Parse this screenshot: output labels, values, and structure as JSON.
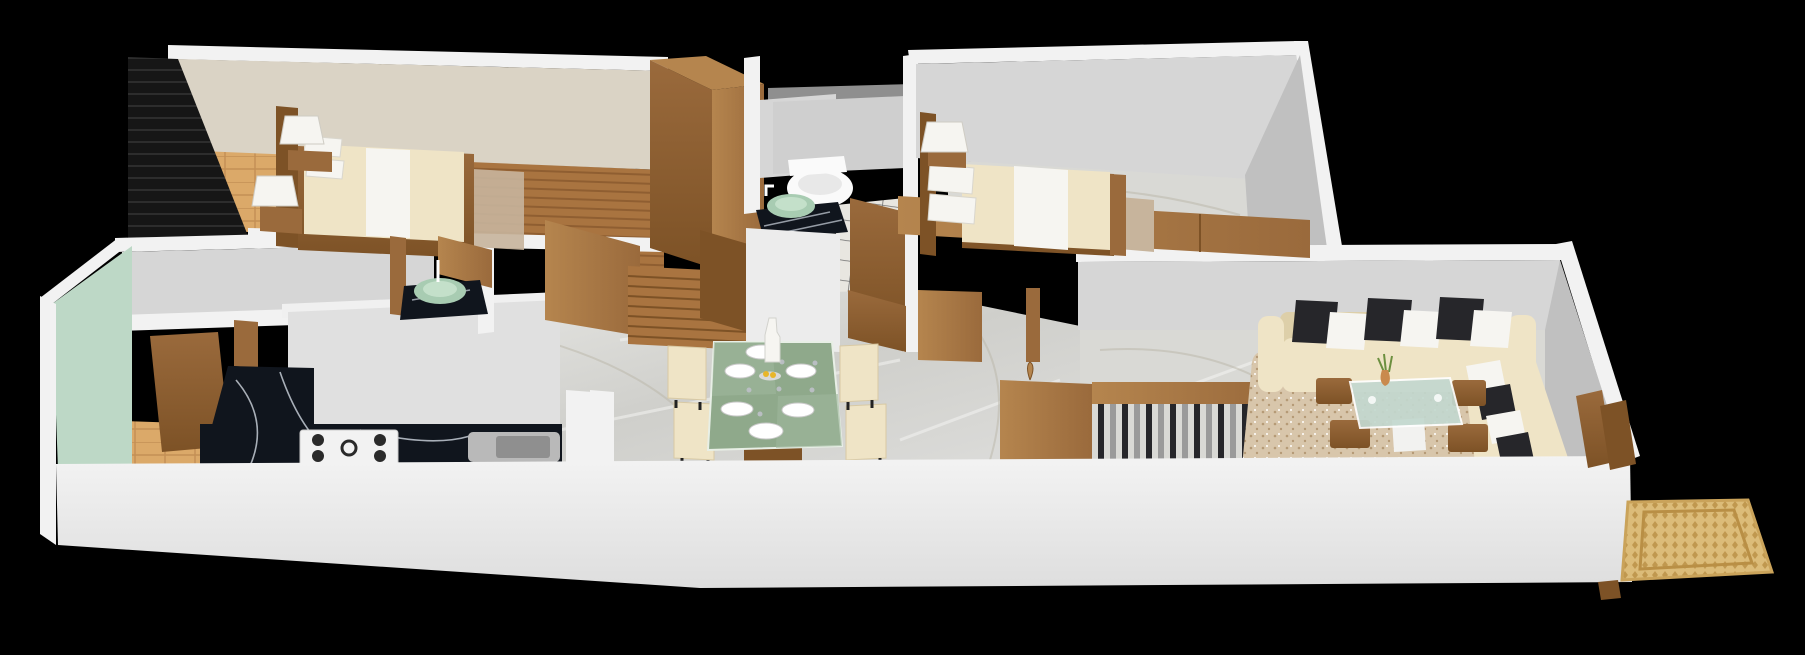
{
  "scene": {
    "kind": "3d-floor-plan-render",
    "description": "Isometric 3D render of an apartment floor plan on a black background",
    "canvas": {
      "width": 1805,
      "height": 655
    }
  },
  "palette": {
    "background": "#000000",
    "wallOuter": "#f2f2f2",
    "wallFace": "#d6d6d6",
    "wallFaceDark": "#c0c0c0",
    "wallBeige": "#dad3c5",
    "mintWall": "#bdd8c6",
    "woodMid": "#9a6a3c",
    "woodDark": "#7d5226",
    "woodLight": "#b5854e",
    "woodFloorA": "#a97440",
    "woodFloorB": "#8f5e31",
    "blackWardrobe": "#161616",
    "tanTile": "#dba969",
    "tanGrout": "#c38f55",
    "marbleFloor": "#d9d9d5",
    "marbleVein": "#b9b5a7",
    "blackMarble": "#10151d",
    "blackMarbleVein": "#cfd6df",
    "cream": "#efe4c6",
    "creamShadow": "#ddcfa9",
    "linenWhite": "#f6f5f1",
    "pillowBlack": "#26262a",
    "glassGreen": "#a8ccb2",
    "diningGlass": "#8fa98b",
    "coffeeGlass": "#c3d8cf",
    "rugBeige": "#d8c6ab",
    "rugSpeckle": "#b59a76",
    "rugBedroom": "#c7b49c",
    "doormatBase": "#dcbc79",
    "doormatPattern": "#b98f45",
    "steelGray": "#9a9a9a",
    "toiletWhite": "#fafafa",
    "plantGreen": "#6c8f3f",
    "fruitYellow": "#e8b62a",
    "tileGrout": "#6f6f6f",
    "bathTile": "#e8e6e0",
    "fascia": "#ececec"
  },
  "rooms": [
    {
      "id": "bedroom-1",
      "position": "top-left",
      "items": [
        "black-slatted-wardrobe",
        "double-bed",
        "wood-headboard",
        "cream-duvet",
        "white-bed-runner",
        "two-white-pillows",
        "two-nightstands",
        "two-pleated-table-lamps",
        "wood-plank-floor",
        "tan-tile-corner",
        "beige-rug"
      ]
    },
    {
      "id": "bathroom",
      "position": "top-center",
      "items": [
        "wall-hung-toilet",
        "green-vessel-sink",
        "black-marble-vanity",
        "faucet",
        "white-tile-floor-dark-grout",
        "wood-partition-doors"
      ]
    },
    {
      "id": "bedroom-2",
      "position": "top-right",
      "items": [
        "double-bed",
        "wood-headboard",
        "cream-duvet",
        "white-bed-runner",
        "white-pillows",
        "pleated-table-lamp",
        "long-wood-wardrobe",
        "marble-floor"
      ]
    },
    {
      "id": "kitchen",
      "position": "bottom-left",
      "items": [
        "l-shaped-black-marble-counter",
        "gas-hob-4-burners",
        "sink",
        "mint-green-wall",
        "tan-tile-floor",
        "wood-door"
      ]
    },
    {
      "id": "wash-area",
      "position": "center-left",
      "items": [
        "green-vessel-sink",
        "black-marble-counter",
        "faucet",
        "wood-panel"
      ]
    },
    {
      "id": "dining",
      "position": "bottom-center",
      "items": [
        "green-glass-dining-table",
        "six-white-plates",
        "glasses",
        "tall-white-bottle-vase",
        "fruit-plate",
        "four-cream-chairs",
        "wood-pedestal",
        "marble-floor"
      ]
    },
    {
      "id": "hallway",
      "position": "center",
      "items": [
        "glossy-marble-floor",
        "wood-staircase",
        "tall-wood-wardrobe",
        "wood-console",
        "small-wood-vase",
        "stair-railing-wood-handrail",
        "black-and-steel-balusters",
        "wood-doors"
      ]
    },
    {
      "id": "living-room",
      "position": "right",
      "items": [
        "l-shaped-cream-sofa",
        "black-and-white-cushions",
        "beige-shag-rug",
        "glass-coffee-table-white-base",
        "four-wood-stools",
        "plant-vase",
        "marble-floor"
      ]
    },
    {
      "id": "entrance",
      "position": "bottom-right",
      "items": [
        "wood-door-panels",
        "ornate-tan-doormat"
      ]
    }
  ],
  "counts": {
    "beds": 2,
    "table_lamps": 3,
    "toilets": 1,
    "vessel_sinks": 2,
    "dining_plates": 6,
    "dining_chairs": 4,
    "sofa_cushions_black": 5,
    "sofa_cushions_white": 5,
    "coffee_table_stools": 4,
    "hob_burners": 4,
    "doormats": 1
  }
}
